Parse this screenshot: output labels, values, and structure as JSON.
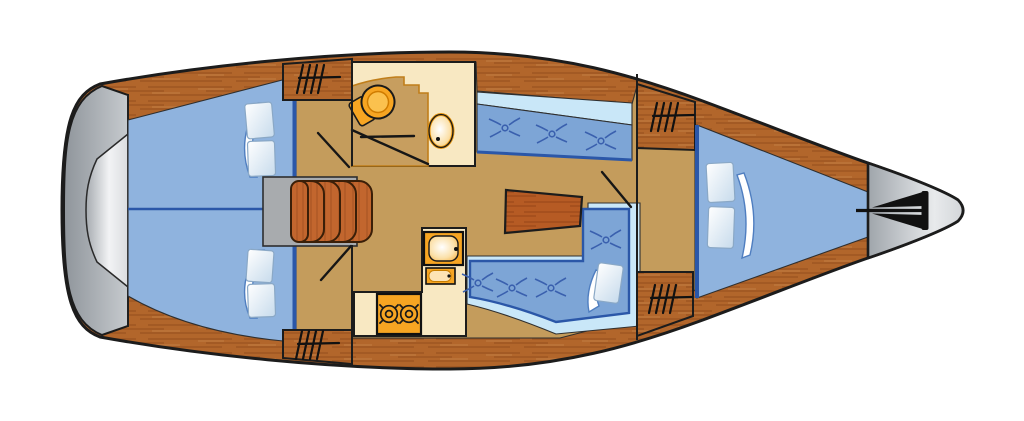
{
  "diagram": {
    "kind": "sailboat-interior-floorplan-top-view",
    "orientation": {
      "bow": "right",
      "stern": "left"
    },
    "colors": {
      "background": "#FFFFFF",
      "outline": "#1C1C1C",
      "hull_wood": "#B2662B",
      "hull_wood_streak": "#8F4E1C",
      "step_wood": "#C2662E",
      "floor_tan": "#C49C5C",
      "counter_cream": "#F8E8C2",
      "head_floor_tan": "#C79E5F",
      "cabin_blue": "#8FB3DE",
      "cushion_blue": "#7DA5D6",
      "accent_blue_dark": "#2B57A8",
      "backrest_blue_light": "#C9E7F8",
      "fixture_orange": "#F7A522",
      "fixture_orange_light": "#FBC14E",
      "hull_gray": "#A9AEB4",
      "hull_gray_light": "#EDEFF1",
      "table_wood": "#B65B24",
      "anchor_black": "#111111"
    },
    "regions": [
      {
        "id": "stern-transom",
        "label": "stern transom"
      },
      {
        "id": "aft-cabin-top",
        "label": "aft double berth (top)"
      },
      {
        "id": "aft-cabin-bottom",
        "label": "aft double berth (bottom)"
      },
      {
        "id": "companionway-steps",
        "label": "companionway steps"
      },
      {
        "id": "head-compartment",
        "label": "head / WC with toilet and washbasin"
      },
      {
        "id": "galley",
        "label": "galley with stove and sink"
      },
      {
        "id": "saloon",
        "label": "saloon with table and settees"
      },
      {
        "id": "v-berth",
        "label": "forward V-berth cabin"
      },
      {
        "id": "bow-anchor",
        "label": "bow with anchor locker"
      }
    ],
    "counts": {
      "deck_hatches": 4,
      "companionway_treads": 5,
      "stove_burners": 2,
      "settee_tufts_top": 3,
      "settee_tufts_bottom": 4,
      "pillows_aft_cabin_each": 2,
      "pillows_v_berth": 2,
      "pillows_settee": 1
    }
  }
}
